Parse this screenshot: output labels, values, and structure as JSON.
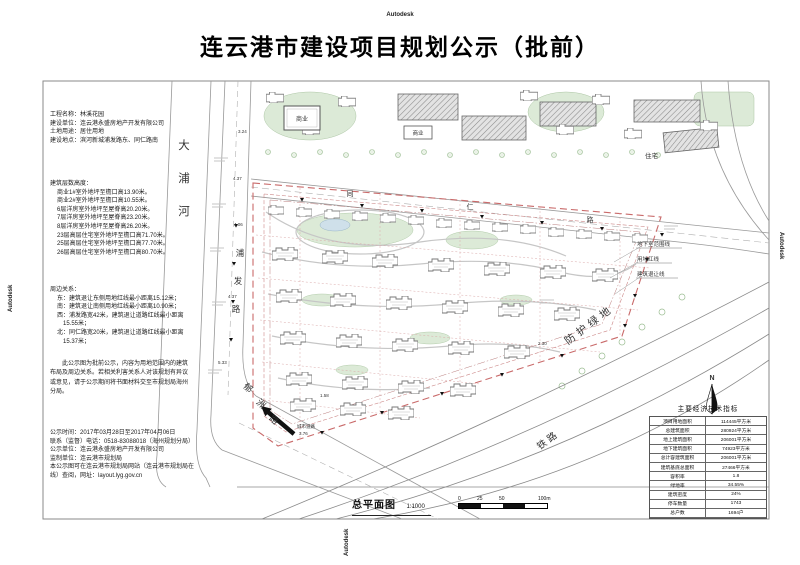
{
  "watermark": "Autodesk",
  "header": {
    "title": "连云港市建设项目规划公示（批前）"
  },
  "project_info": {
    "line1": "工程名称：林溪花园",
    "line2": "建设单位：连云港永盛房地产开发有限公司",
    "line3": "土地用途：居住用地",
    "line4": "建设地点：滨河新城浦发路东、同仁路南"
  },
  "heights": {
    "heading": "建筑层数高度：",
    "items": [
      "商业1#室外地坪至檐口高13.90米。",
      "商业2#室外地坪至檐口高10.55米。",
      "6层洋房室外地坪至屋脊高20.20米。",
      "7层洋房室外地坪至屋脊高23.20米。",
      "8层洋房室外地坪至屋脊高26.20米。",
      "23层高层住宅室外地坪至檐口高71.70米。",
      "25层高层住宅室外地坪至檐口高77.70米。",
      "26层高层住宅室外地坪至檐口高80.70米。"
    ]
  },
  "relations": {
    "heading": "周边关系：",
    "items": [
      "东：建筑退让东侧用地红线最小距离15.12米；",
      "南：建筑退让南侧用地红线最小距离10.90米；",
      "西：浦发路宽42米，建筑退让道路红线最小距离15.55米；",
      "北：同仁路宽20米，建筑退让道路红线最小距离15.37米；"
    ]
  },
  "notice": "此公示图为批前公示，内容为用地范围内的建筑布局及周边关系。若相关利害关系人对该规划有异议或意见，请于公示期间将书面材料交至市规划局海州分局。",
  "publicity": {
    "items": [
      "公示时间：2017年03月28日至2017年04月06日",
      "联系（监督）电话：0518-83088018（海州规划分局）",
      "公示单位：连云港永盛房地产开发有限公司",
      "监制单位：连云港市规划局",
      "本公示图可在连云港市规划局网站（连云港市规划局在线）查阅，网址：layout.lyg.gov.cn"
    ]
  },
  "map": {
    "river": [
      "大",
      "浦",
      "河"
    ],
    "pufa_road": [
      "浦",
      "发",
      "路"
    ],
    "yuzhou_road": [
      "郁",
      "洲",
      "路"
    ],
    "tongren_road": [
      "同",
      "仁",
      "路"
    ],
    "green_buffer": "防护绿地",
    "railway": "铁路",
    "residential_label": "住宅",
    "commercial_label": "商业",
    "legend": {
      "basement": "地下室范围线",
      "red_line": "用地红线",
      "setback": "建筑退让线"
    },
    "entrance": {
      "label": "城市道路",
      "elevation": "3.76"
    },
    "elevations": [
      "3.24",
      "4.37",
      "4.06",
      "4.37",
      "5.33",
      "2.30",
      "1.58"
    ],
    "north": "N"
  },
  "indicators": {
    "title": "主要经济技术指标",
    "rows": [
      {
        "label": "项目用地面积",
        "value": "114445平方米"
      },
      {
        "label": "总建筑面积",
        "value": "280924平方米"
      },
      {
        "label": "地上建筑面积",
        "value": "206001平方米"
      },
      {
        "label": "地下建筑面积",
        "value": "74923平方米"
      },
      {
        "label": "总计容建筑面积",
        "value": "206001平方米"
      },
      {
        "label": "建筑基底总面积",
        "value": "27466平方米"
      },
      {
        "label": "容积率",
        "value": "1.8"
      },
      {
        "label": "绿地率",
        "value": "34.55%"
      },
      {
        "label": "建筑密度",
        "value": "24%"
      },
      {
        "label": "停车数量",
        "value": "1743"
      },
      {
        "label": "总户数",
        "value": "1694户"
      }
    ]
  },
  "footer": {
    "drawing_name": "总平面图",
    "scale": "1:1000",
    "scalebar": {
      "t0": "0",
      "t25": "25",
      "t50": "50",
      "t100": "100m"
    }
  },
  "colors": {
    "boundary_red": "#c96a6a",
    "green": "#dcead7",
    "line_gray": "#999999"
  }
}
